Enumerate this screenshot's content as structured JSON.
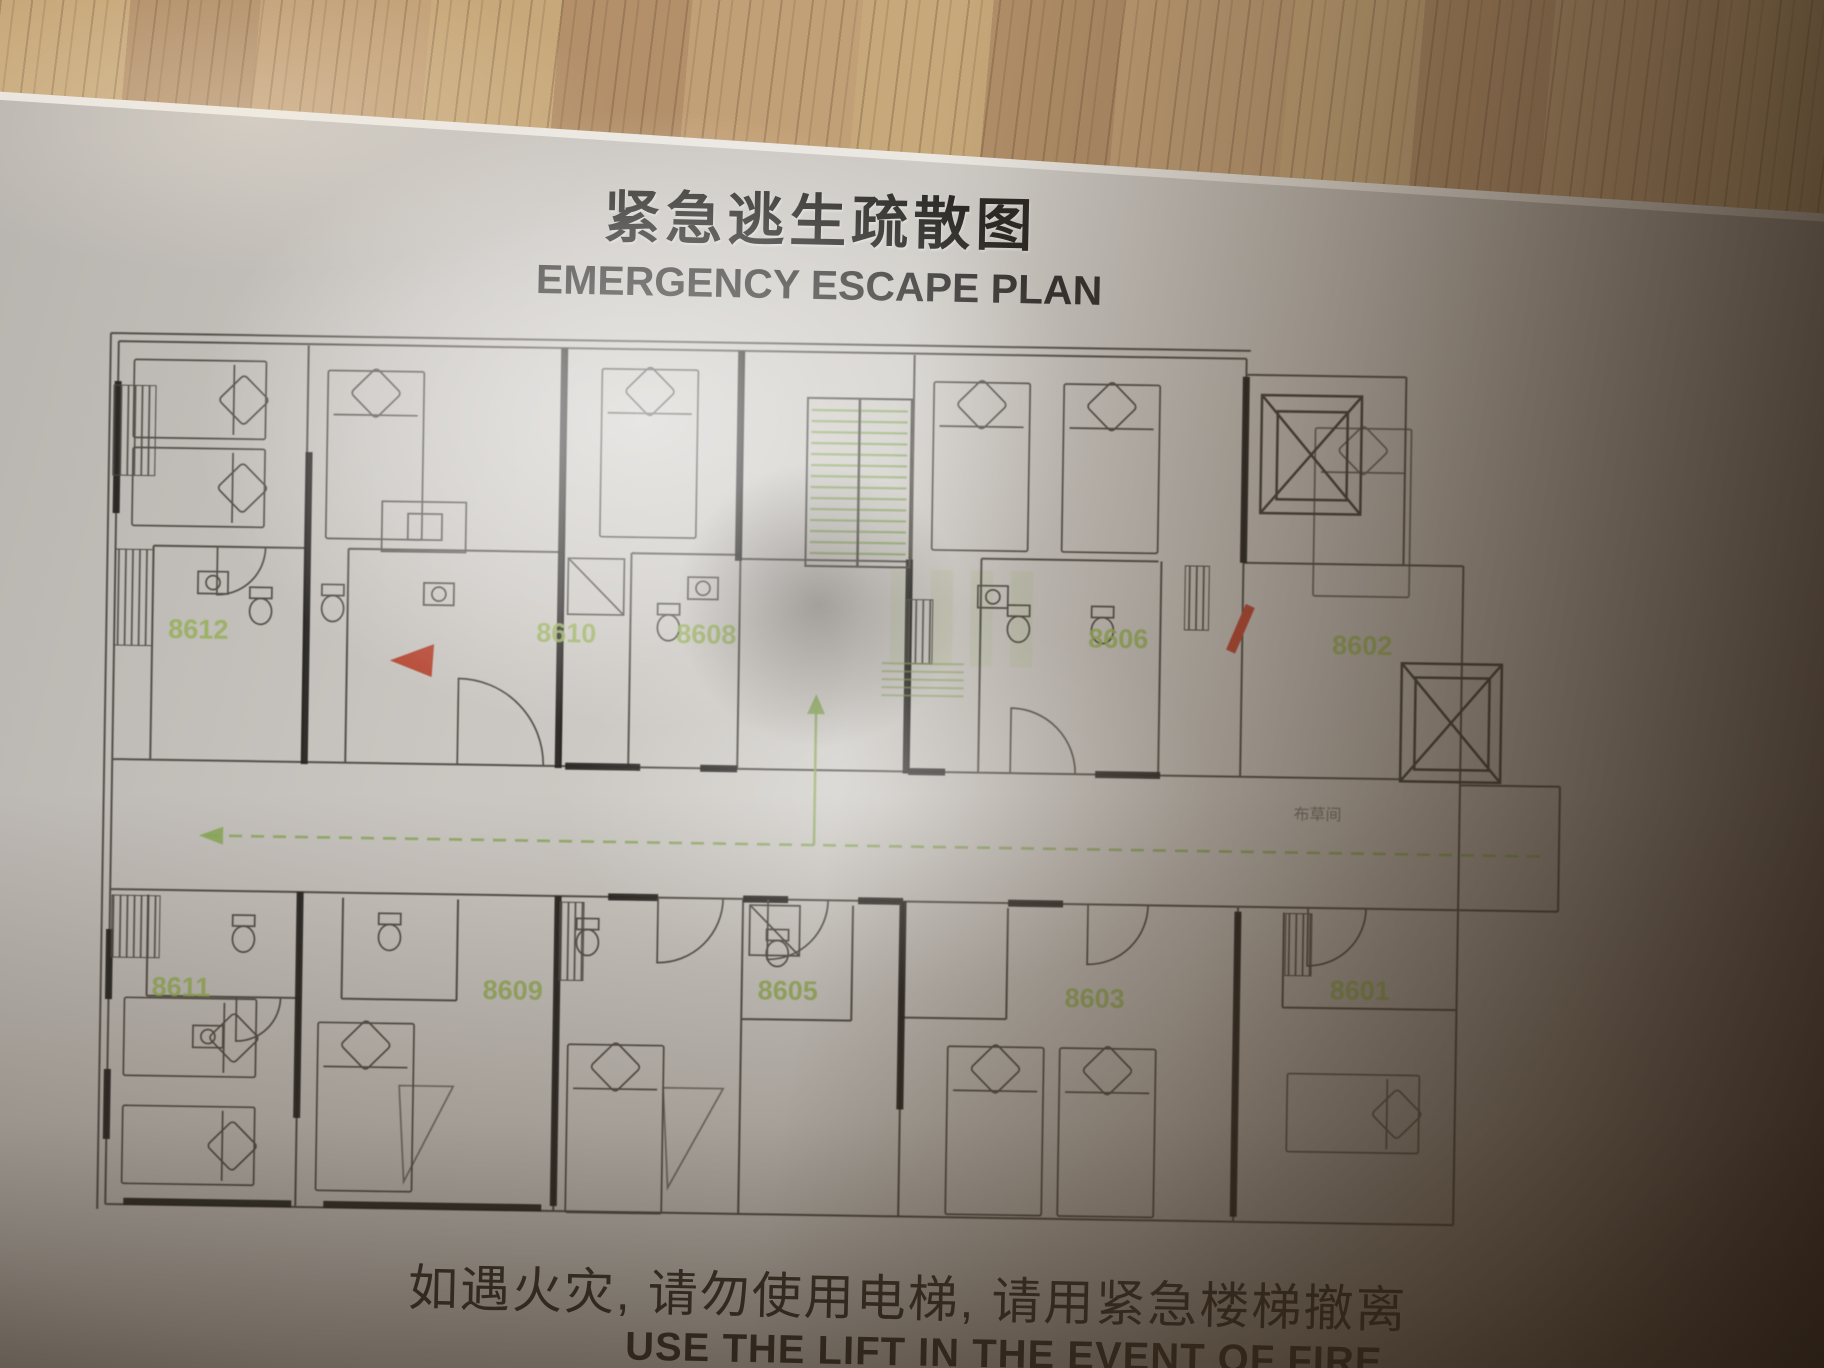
{
  "photo": {
    "sign": {
      "title_cn": "紧急逃生疏散图",
      "title_en": "EMERGENCY ESCAPE PLAN",
      "footer_cn": "如遇火灾, 请勿使用电梯, 请用紧急楼梯撤离",
      "footer_en": "USE THE LIFT IN THE EVENT OF FIRE",
      "plan": {
        "rooms_top": [
          {
            "number": "8612"
          },
          {
            "number": "8610"
          },
          {
            "number": "8608"
          },
          {
            "number": "8606"
          },
          {
            "number": "8602"
          }
        ],
        "rooms_bottom": [
          {
            "number": "8611"
          },
          {
            "number": "8609"
          },
          {
            "number": "8605"
          },
          {
            "number": "8603"
          },
          {
            "number": "8601"
          }
        ],
        "linen_room_label": "布草间",
        "colors": {
          "room_number_green": "#95b054",
          "route_green": "#86a653",
          "stair_green": "#7fa04f",
          "alarm_red": "#b5402c"
        }
      }
    }
  }
}
